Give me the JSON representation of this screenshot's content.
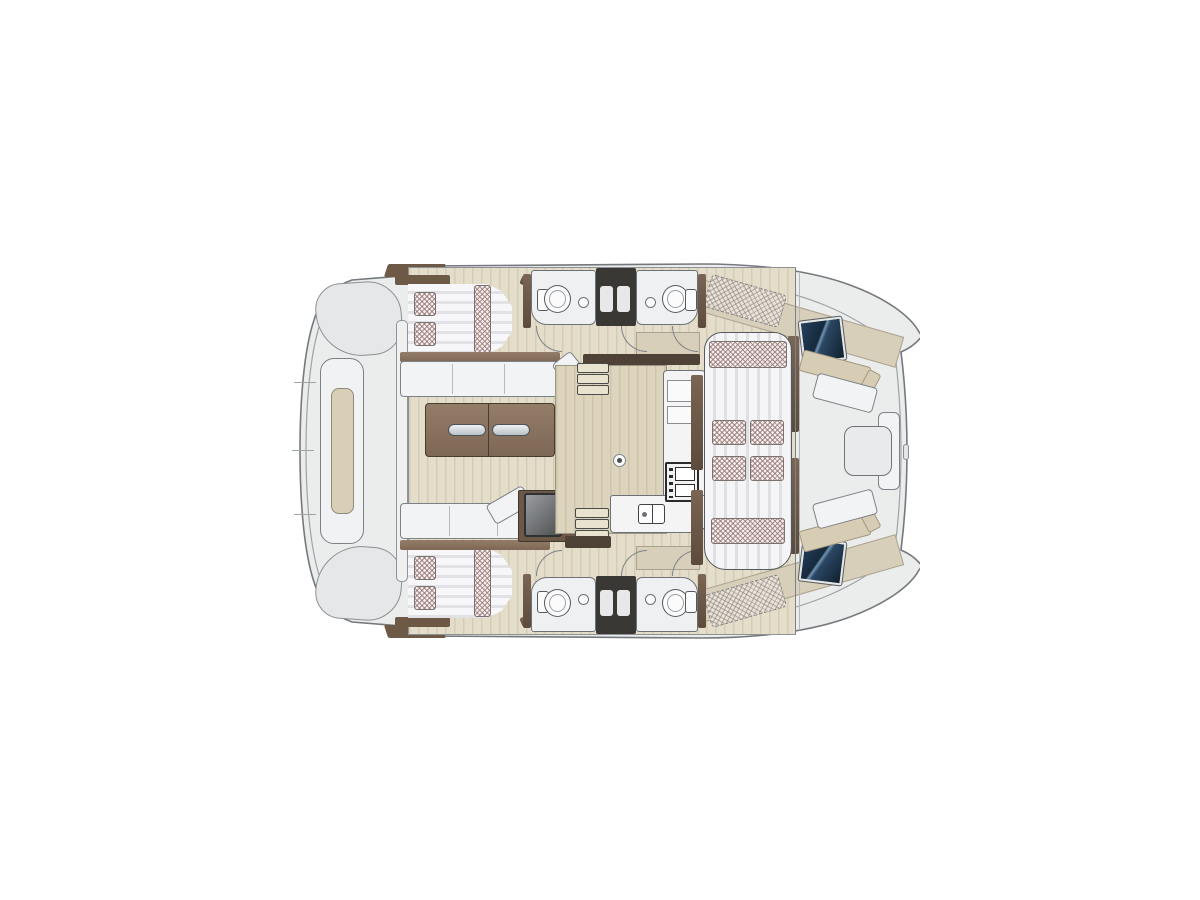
{
  "figure": {
    "type": "yacht-floor-plan",
    "subject": "catamaran-deck-plan-top-view",
    "orientation": "bow-right"
  },
  "palette": {
    "bg": "#ffffff",
    "deck": "#ebecec",
    "deckLine": "#75797d",
    "innerLine": "#9ea3a7",
    "floorBeige": "#e4ddca",
    "galleyFloor": "#ddd4bd",
    "sideDeck": "#d8cfba",
    "cushion": "#f2f3f4",
    "outline": "#7d8287",
    "tan": "#d7cdb4",
    "hatchBase": "#f3eeeb",
    "partition": "#3a3835",
    "fixture": "#fbfbfc",
    "woodDark": "#5c4b3d",
    "hatchBlue": "#1f3a54",
    "steel": "#c7ced4"
  },
  "parts": [
    "aft-swim-platform",
    "aft-bench",
    "port-aft-cabin-bed",
    "starboard-aft-cabin-bed",
    "salon-sofa",
    "salon-table",
    "port-head-toilet",
    "port-head-sink",
    "starboard-head-toilet",
    "starboard-head-sink",
    "shower-partition",
    "galley-counter",
    "galley-stove",
    "galley-sink",
    "companionway-steps",
    "fridge-unit",
    "forward-dinette",
    "dinette-cushions",
    "side-deck-sunpad",
    "forward-cockpit-bench",
    "forward-cockpit-table",
    "deck-hatch",
    "bow-tips"
  ]
}
